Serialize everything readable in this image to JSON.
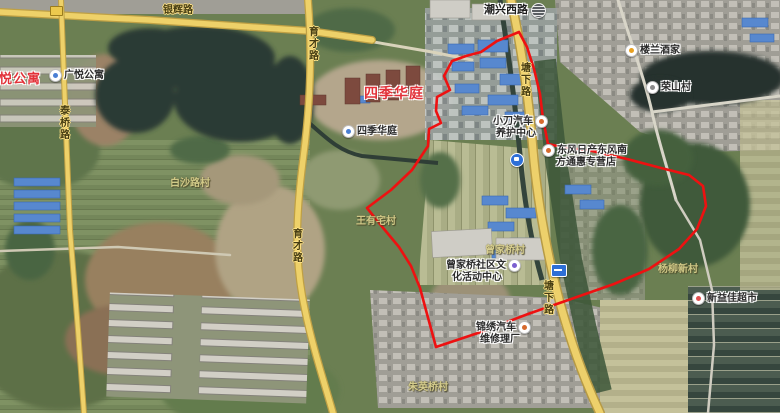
{
  "map": {
    "boundary_color": "#ee1111",
    "road_color": "#eed169",
    "road_labels": {
      "yinhui": "银辉路",
      "taoqiao": "泰桥路",
      "yucai_n": "育才路",
      "yucai_s": "育才路",
      "chaoxing_w": "潮兴西路",
      "tangxia_n": "塘下路",
      "tangxia_s": "塘下路"
    },
    "estates": {
      "guangyue": "广悦公寓",
      "sijihuating": "四季华庭"
    },
    "pois": {
      "guangyue": "广悦公寓",
      "sijihuating": "四季华庭",
      "xiaodao_l1": "小刀汽车",
      "xiaodao_l2": "养护中心",
      "dongfeng_l1": "东风日产东风南",
      "dongfeng_l2": "方通惠专营店",
      "loulan": "楼兰酒家",
      "rongshan": "荣山村",
      "community_l1": "曾家桥社区文",
      "community_l2": "化活动中心",
      "jinxiu_l1": "锦绣汽车",
      "jinxiu_l2": "维修理厂",
      "xinyijia": "新益佳超市"
    },
    "villages": {
      "baishalu": "白沙路村",
      "wangyouzhai": "王有宅村",
      "zengjiaqiao": "曾家桥村",
      "yangliu": "杨柳新村",
      "zhuyingqiao": "朱英桥村"
    }
  }
}
